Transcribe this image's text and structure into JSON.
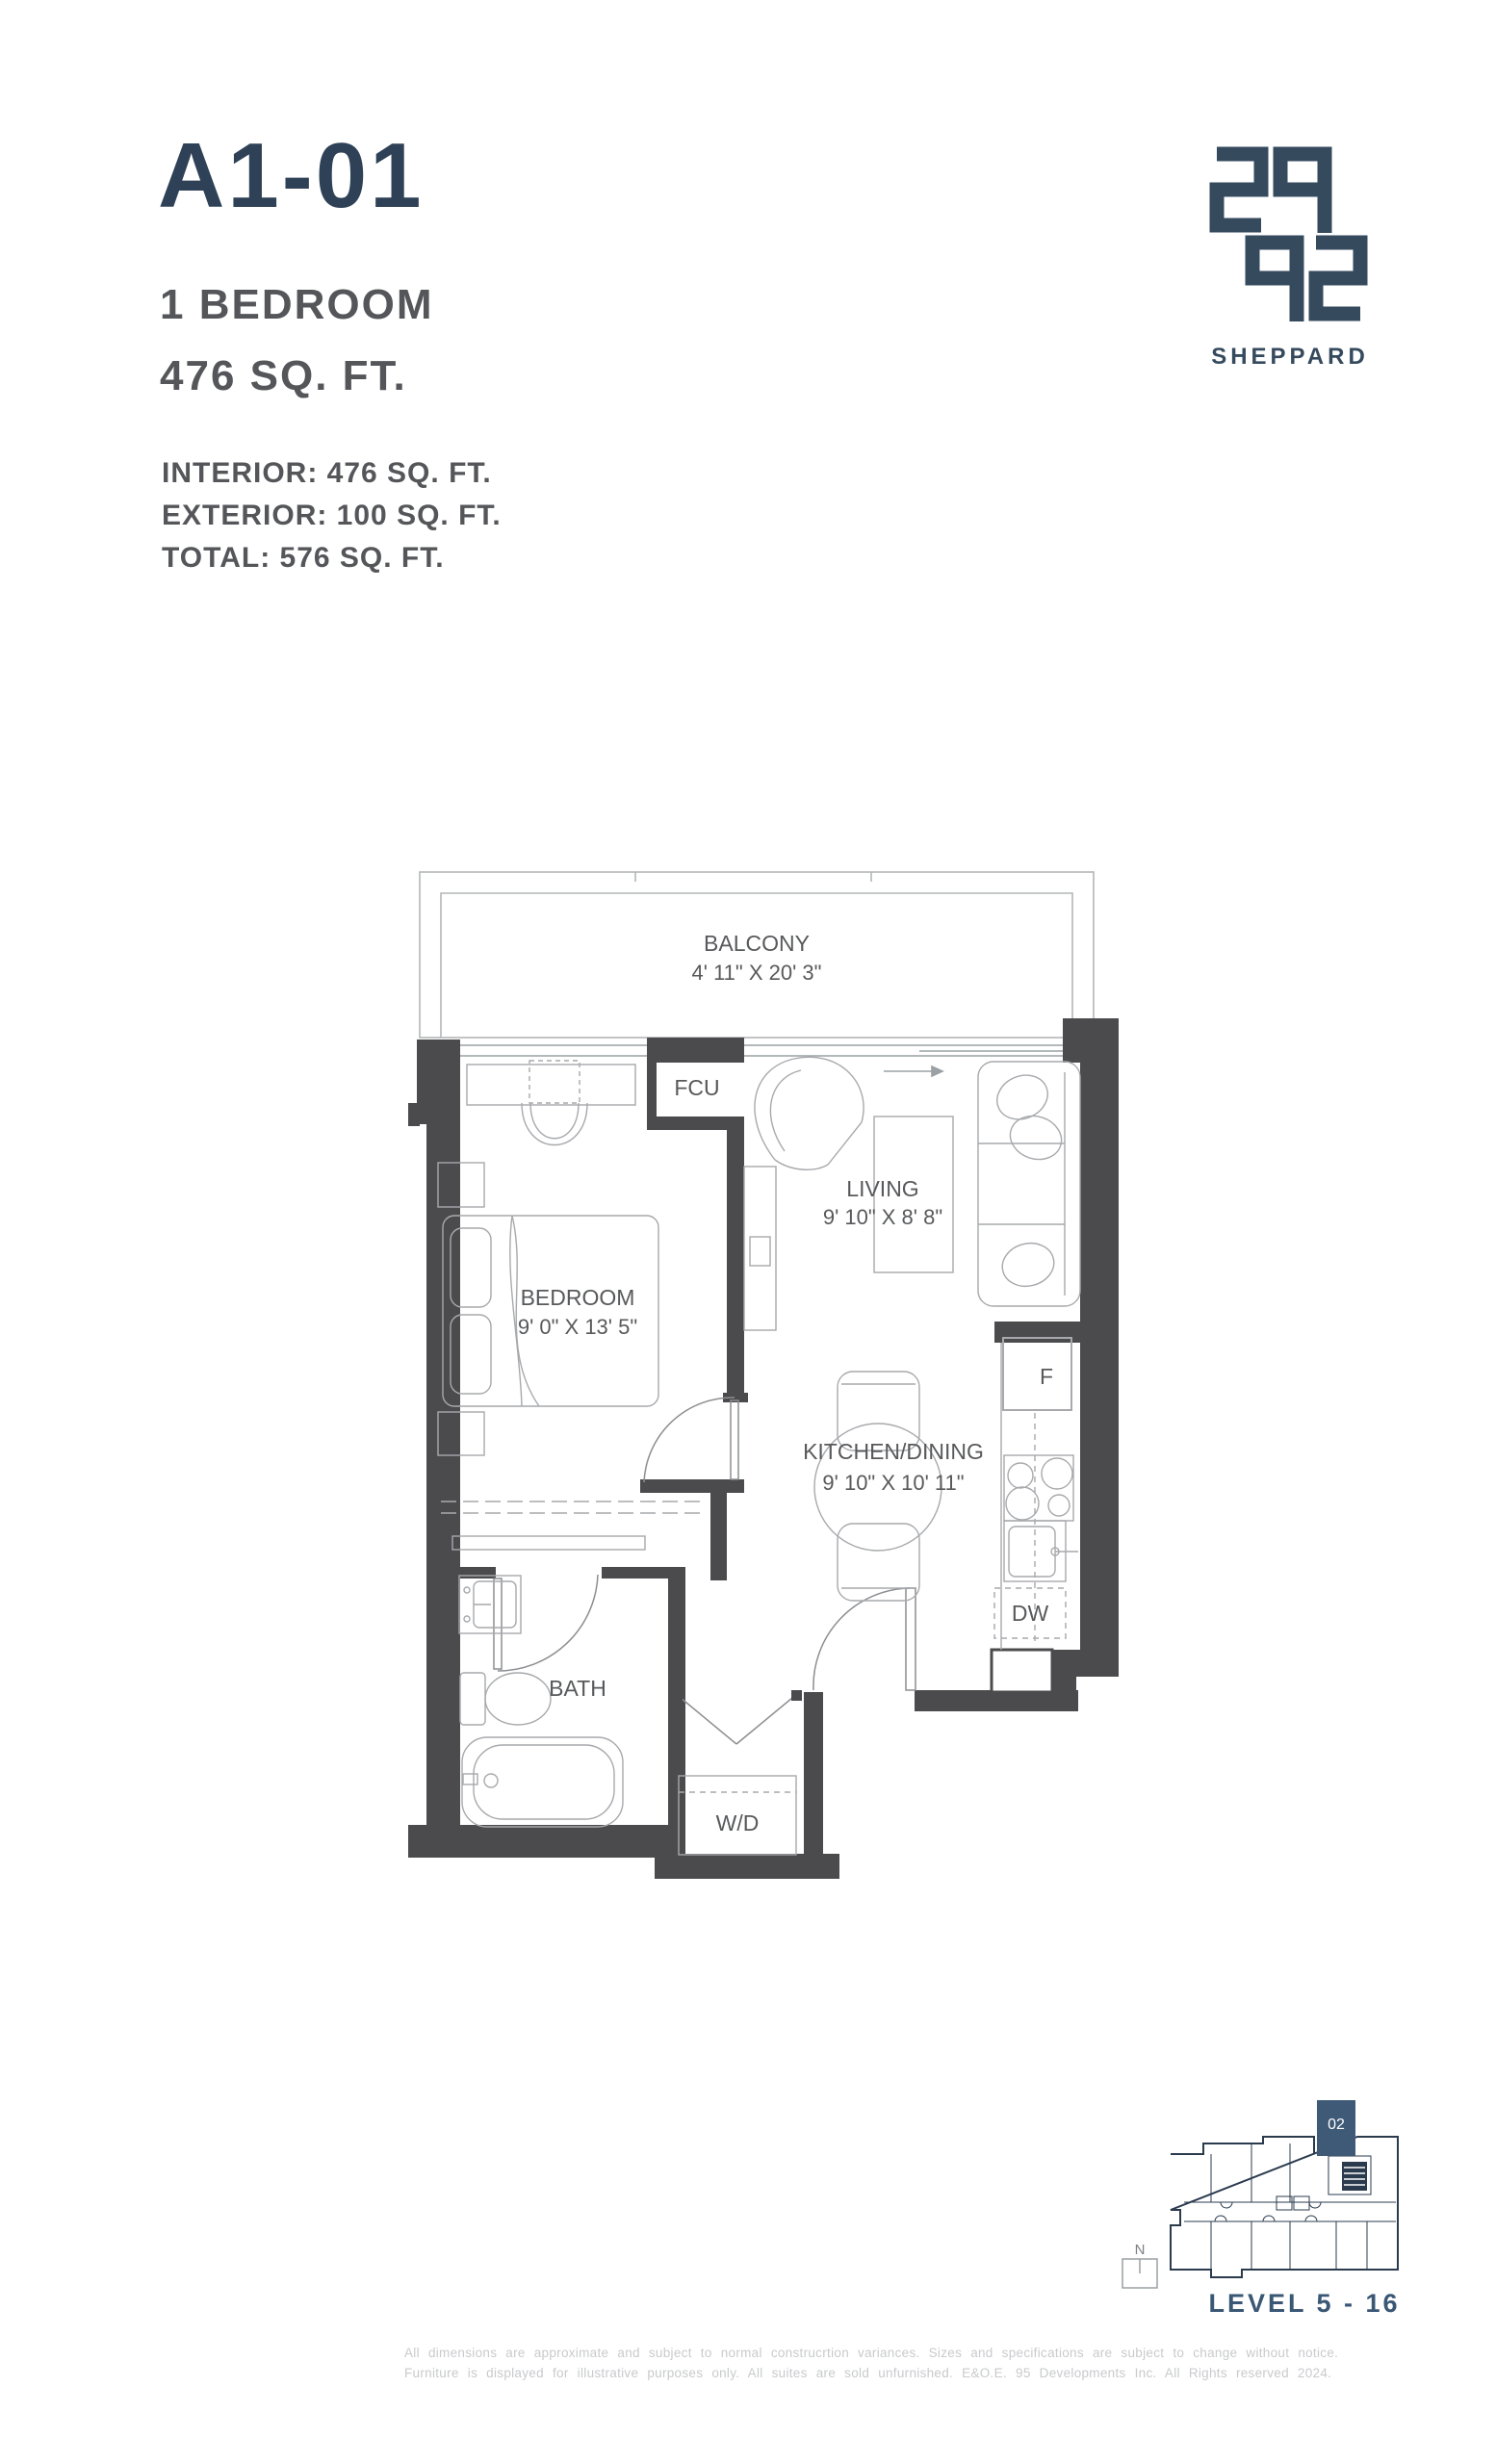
{
  "header": {
    "unit_code": "A1-01",
    "unit_type": "1 BEDROOM",
    "unit_area": "476 SQ. FT.",
    "interior": "INTERIOR:  476 SQ. FT.",
    "exterior": "EXTERIOR: 100 SQ. FT.",
    "total": "TOTAL: 576 SQ. FT."
  },
  "logo": {
    "digits": "2992",
    "wordmark": "SHEPPARD"
  },
  "floorplan": {
    "balcony": {
      "name": "BALCONY",
      "dims": "4' 11\" X 20' 3\""
    },
    "living": {
      "name": "LIVING",
      "dims": "9' 10\" X 8' 8\""
    },
    "bedroom": {
      "name": "BEDROOM",
      "dims": "9' 0\"  X 13' 5\""
    },
    "kitchen": {
      "name": "KITCHEN/DINING",
      "dims": "9' 10\" X 10' 11\""
    },
    "bath": {
      "name": "BATH"
    },
    "fcu": "FCU",
    "washer_dryer": "W/D",
    "fridge": "F",
    "dishwasher": "DW"
  },
  "keyplan": {
    "unit_number": "02",
    "north_label": "N",
    "level_label": "LEVEL 5 - 16"
  },
  "disclaimer": {
    "line1": "All dimensions are approximate and subject to normal construcrtion variances.  Sizes and specifications are subject to change without notice.",
    "line2": "Furniture is displayed for illustrative purposes only. All suites are sold unfurnished. E&O.E. 95 Developments Inc. All Rights reserved 2024."
  },
  "colors": {
    "title_navy": "#2e4156",
    "logo_navy": "#364a5e",
    "text_gray": "#55565a",
    "wall_dark": "#4b4b4d",
    "line_gray": "#a7a9ac",
    "label_gray": "#58595b",
    "level_navy": "#3a5775",
    "keyplan_line": "#2b3b4e",
    "unit_highlight": "#3e5a77",
    "disclaimer_gray": "#c9cacc"
  }
}
